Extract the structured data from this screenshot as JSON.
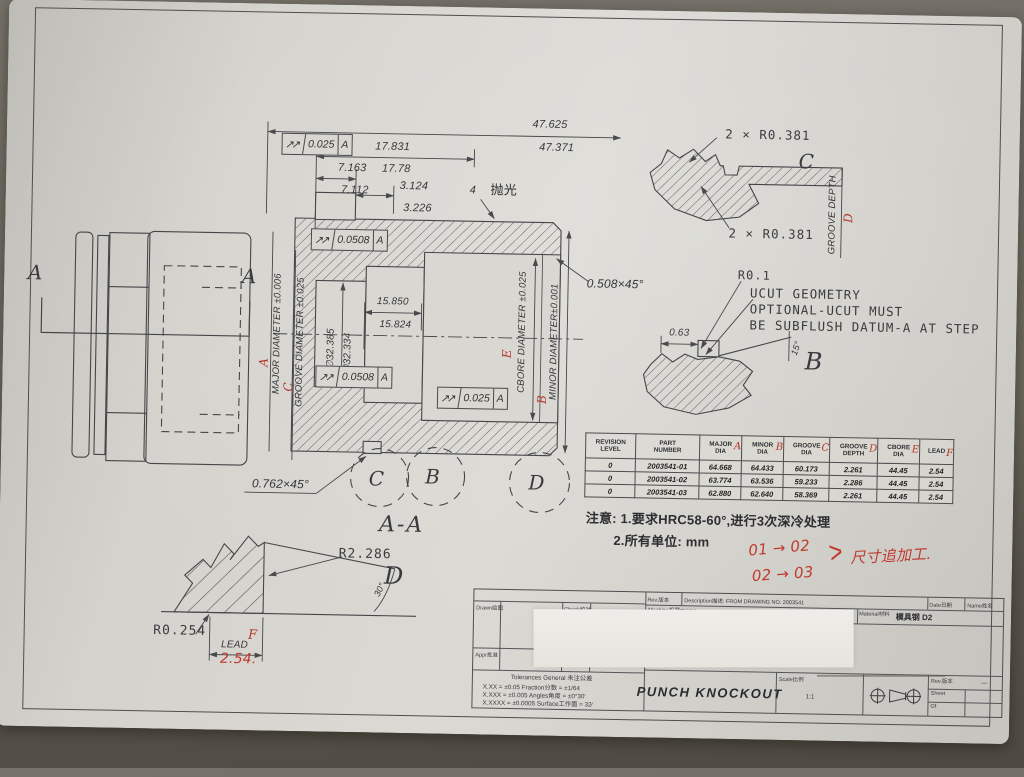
{
  "view": {
    "aa_left": "A",
    "aa_right": "A",
    "section": "A-A",
    "polish_num": "4",
    "polish": "抛光",
    "circle_c": "C",
    "circle_b": "B",
    "circle_d": "D"
  },
  "dims": {
    "overall_u": "47.625",
    "overall_l": "47.371",
    "l17_u": "17.831",
    "l17_l": "17.78",
    "l7_u": "7.163",
    "l7_l": "7.112",
    "l3_u": "3.124",
    "l3_l": "3.226",
    "l15_u": "15.850",
    "l15_l": "15.824",
    "dia_u": "∅32.385",
    "dia_l": "∅32.334",
    "chamfer_right": "0.508×45°",
    "chamfer_left": "0.762×45°"
  },
  "labels": {
    "major": "MAJOR DIAMETER ±0.006",
    "groove": "GROOVE DIAMETER ±0.025",
    "cbore": "CBORE DIAMETER ±0.025",
    "minor": "MINOR DIAMETER±0.001",
    "marks": {
      "a": "A",
      "b": "B",
      "c": "C",
      "d": "D",
      "e": "E",
      "f": "F"
    }
  },
  "gdt": {
    "sym": "↗↗",
    "f1": {
      "tol": "0.025",
      "datum": "A"
    },
    "f2": {
      "tol": "0.0508",
      "datum": "A"
    },
    "f3": {
      "tol": "0.0508",
      "datum": "A"
    },
    "f4": {
      "tol": "0.025",
      "datum": "A"
    }
  },
  "groove_detail": {
    "r_top": "2 × R0.381",
    "r_bot": "2 × R0.381",
    "c": "C",
    "depth": "GROOVE DEPTH"
  },
  "ucut": {
    "r": "R0.1",
    "l1": "UCUT GEOMETRY",
    "l2": "OPTIONAL-UCUT MUST",
    "l3": "BE SUBFLUSH DATUM-A AT STEP",
    "w": "0.63",
    "ang": "15°",
    "b": "B"
  },
  "lead_detail": {
    "r_big": "R2.286",
    "r_small": "R0.254",
    "ang": "30°",
    "d": "D",
    "lead": "LEAD",
    "hand": "2.54."
  },
  "table": {
    "columns": [
      {
        "l1": "REVISION",
        "l2": "LEVEL",
        "mark": ""
      },
      {
        "l1": "PART",
        "l2": "NUMBER",
        "mark": ""
      },
      {
        "l1": "MAJOR",
        "l2": "DIA",
        "mark": "A"
      },
      {
        "l1": "MINOR",
        "l2": "DIA",
        "mark": "B"
      },
      {
        "l1": "GROOVE",
        "l2": "DIA",
        "mark": "C"
      },
      {
        "l1": "GROOVE",
        "l2": "DEPTH",
        "mark": "D"
      },
      {
        "l1": "CBORE",
        "l2": "DIA",
        "mark": "E"
      },
      {
        "l1": "LEAD",
        "l2": "",
        "mark": "F"
      }
    ],
    "rows": [
      [
        "0",
        "2003541-01",
        "64.668",
        "64.433",
        "60.173",
        "2.261",
        "44.45",
        "2.54"
      ],
      [
        "0",
        "2003541-02",
        "63.774",
        "63.536",
        "59.233",
        "2.286",
        "44.45",
        "2.54"
      ],
      [
        "0",
        "2003541-03",
        "62.880",
        "62.640",
        "58.369",
        "2.261",
        "44.45",
        "2.54"
      ]
    ]
  },
  "notes": {
    "t": "注意:",
    "n1": "1.要求HRC58-60°,进行3次深冷处理",
    "n2": "2.所有单位: mm"
  },
  "redline": {
    "l1": "01 → 02",
    "l2": "02 → 03",
    "bracket": ">",
    "text": "尺寸追加工."
  },
  "titleblock": {
    "rev": "Rev.版本",
    "description": "Description描述: FROM DRAWING NO. 2003541",
    "date": "Date日期",
    "name": "Name姓名",
    "machine": "Machine机器",
    "machine_value": "螺帽机",
    "material": "Material材料",
    "material_value": "模具钢 D2",
    "drawn": "Drawn绘图",
    "check": "Check校对",
    "appr": "Appr批准",
    "count": "Count会签",
    "tol_title": "Tolerances General 未注公差",
    "tol1": "X.XX = ±0.05    Fraction分数 = ±1/64",
    "tol2": "X.XXX = ±0.005   Angles角度 = ±0°30′",
    "tol3": "X.XXXX = ±0.0005  Surface工作面 = 32∕",
    "title": "PUNCH KNOCKOUT",
    "scale": "Scale比例",
    "scale_value": "1:1",
    "rev2": "Rev.版本",
    "rev_value": "—",
    "sheet": "Sheet",
    "of": "Of"
  }
}
